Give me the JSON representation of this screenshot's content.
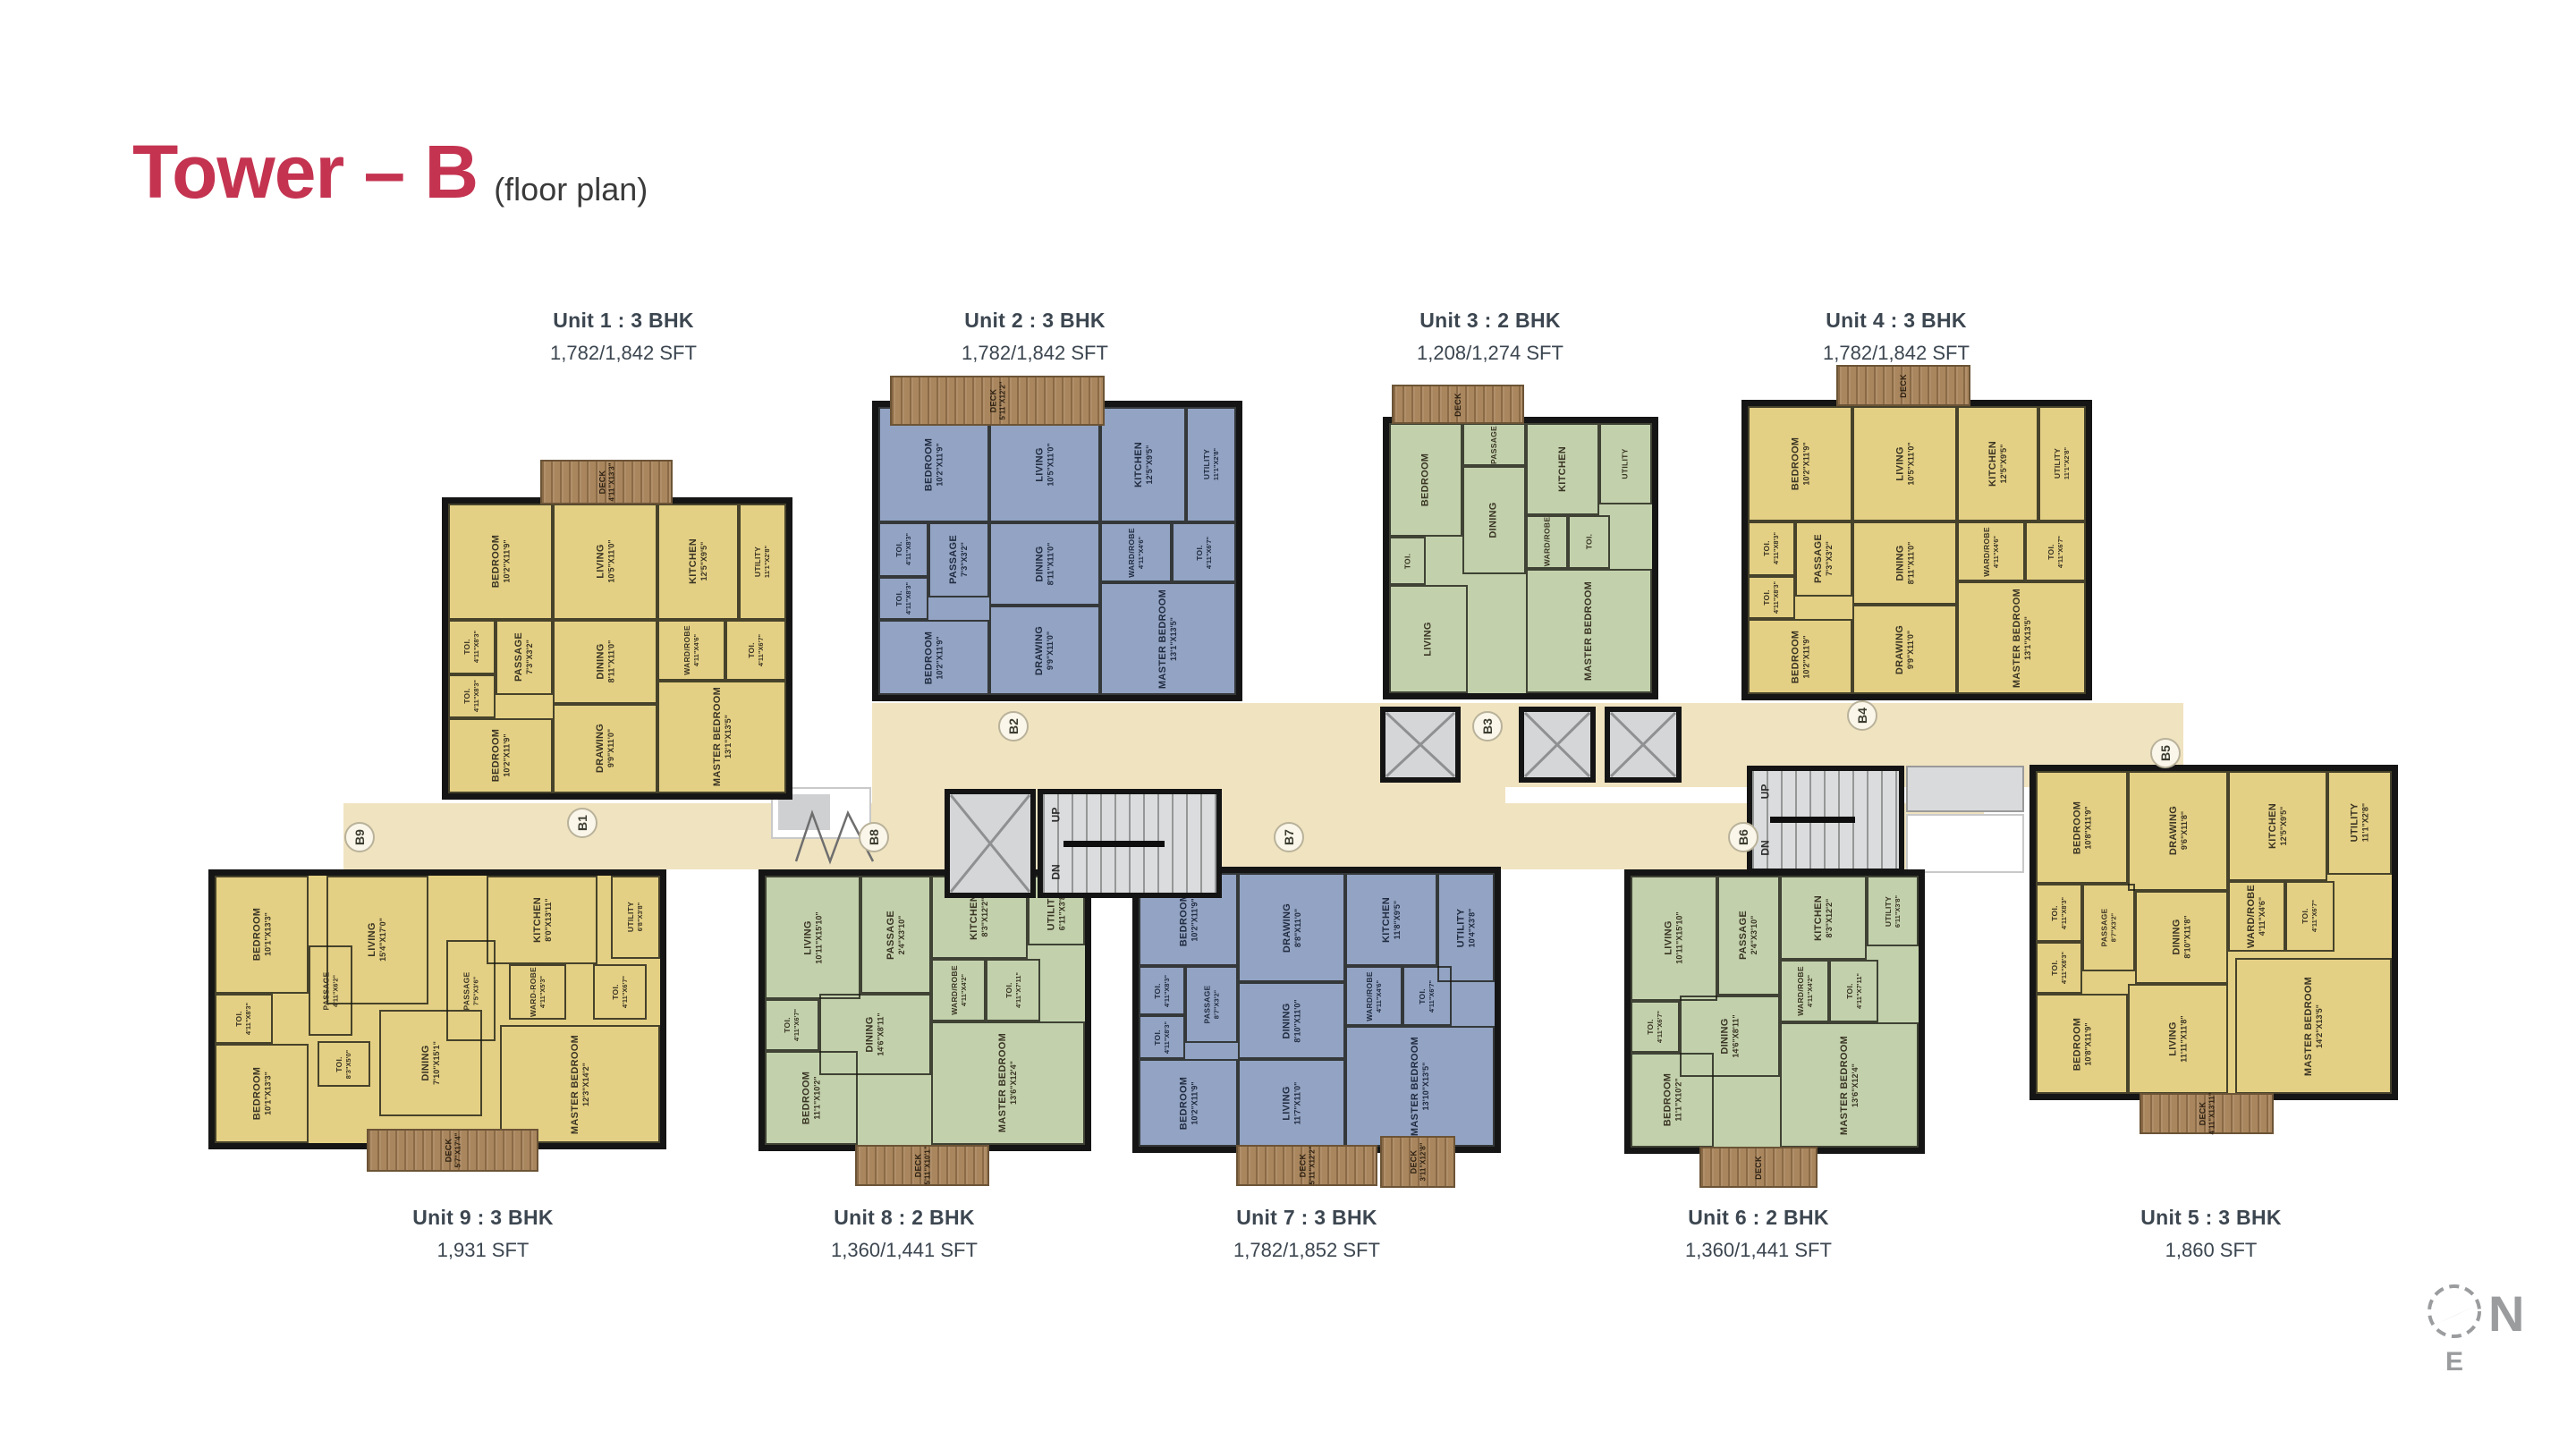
{
  "title": {
    "main": "Tower – B",
    "sub": "(floor plan)"
  },
  "colors": {
    "yellow": "#e4d084",
    "blue": "#92a3c3",
    "green": "#c2d1ac",
    "corridor": "#f0e3c0",
    "deck": "#a9865d",
    "wall": "#151515",
    "title_red": "#c43350",
    "label_text": "#3c4650"
  },
  "compass": {
    "n": "N",
    "e": "E"
  },
  "stairwell": {
    "up": "UP",
    "dn": "DN"
  },
  "typologies": {
    "t3": {
      "rooms": [
        {
          "n": "BEDROOM",
          "d": "10'2\"X11'9\"",
          "x": 0,
          "y": 0,
          "w": 31,
          "h": 40
        },
        {
          "n": "LIVING",
          "d": "10'5\"X11'0\"",
          "x": 31,
          "y": 0,
          "w": 31,
          "h": 40
        },
        {
          "n": "KITCHEN",
          "d": "12'5\"X9'5\"",
          "x": 62,
          "y": 0,
          "w": 24,
          "h": 40
        },
        {
          "n": "UTILITY",
          "d": "11'1\"X2'8\"",
          "x": 86,
          "y": 0,
          "w": 14,
          "h": 40
        },
        {
          "n": "TOI.",
          "d": "4'11\"X8'3\"",
          "x": 0,
          "y": 40,
          "w": 14,
          "h": 19
        },
        {
          "n": "PASSAGE",
          "d": "7'3\"X3'2\"",
          "x": 14,
          "y": 40,
          "w": 17,
          "h": 26
        },
        {
          "n": "DINING",
          "d": "8'11\"X11'0\"",
          "x": 31,
          "y": 40,
          "w": 31,
          "h": 29
        },
        {
          "n": "WARD/ROBE",
          "d": "4'11\"X4'6\"",
          "x": 62,
          "y": 40,
          "w": 20,
          "h": 21
        },
        {
          "n": "TOI.",
          "d": "4'11\"X6'7\"",
          "x": 82,
          "y": 40,
          "w": 18,
          "h": 21
        },
        {
          "n": "TOI.",
          "d": "4'11\"X8'3\"",
          "x": 0,
          "y": 59,
          "w": 14,
          "h": 15
        },
        {
          "n": "BEDROOM",
          "d": "10'2\"X11'9\"",
          "x": 0,
          "y": 74,
          "w": 31,
          "h": 26
        },
        {
          "n": "DRAWING",
          "d": "9'9\"X11'0\"",
          "x": 31,
          "y": 69,
          "w": 31,
          "h": 31
        },
        {
          "n": "MASTER BEDROOM",
          "d": "13'1\"X13'5\"",
          "x": 62,
          "y": 61,
          "w": 38,
          "h": 39
        }
      ]
    },
    "t2": {
      "rooms": [
        {
          "n": "LIVING",
          "d": "10'11\"X15'10\"",
          "x": 0,
          "y": 0,
          "w": 30,
          "h": 46
        },
        {
          "n": "PASSAGE",
          "d": "2'4\"X3'10\"",
          "x": 30,
          "y": 0,
          "w": 22,
          "h": 44
        },
        {
          "n": "KITCHEN",
          "d": "8'3\"X12'2\"",
          "x": 52,
          "y": 0,
          "w": 30,
          "h": 31
        },
        {
          "n": "UTILITY",
          "d": "6'11\"X3'8\"",
          "x": 82,
          "y": 0,
          "w": 18,
          "h": 26
        },
        {
          "n": "TOI.",
          "d": "4'11\"X6'7\"",
          "x": 0,
          "y": 46,
          "w": 17,
          "h": 19
        },
        {
          "n": "WARD/ROBE",
          "d": "4'11\"X4'2\"",
          "x": 52,
          "y": 31,
          "w": 17,
          "h": 23
        },
        {
          "n": "TOI.",
          "d": "4'11\"X7'11\"",
          "x": 69,
          "y": 31,
          "w": 17,
          "h": 23
        },
        {
          "n": "DINING",
          "d": "14'6\"X8'11\"",
          "x": 17,
          "y": 44,
          "w": 35,
          "h": 30
        },
        {
          "n": "BEDROOM",
          "d": "11'1\"X10'2\"",
          "x": 0,
          "y": 65,
          "w": 29,
          "h": 35
        },
        {
          "n": "MASTER BEDROOM",
          "d": "13'6\"X12'4\"",
          "x": 52,
          "y": 54,
          "w": 48,
          "h": 46
        }
      ]
    },
    "t3g": {
      "rooms": [
        {
          "n": "BEDROOM",
          "d": "",
          "x": 0,
          "y": 0,
          "w": 28,
          "h": 42
        },
        {
          "n": "DINING",
          "d": "",
          "x": 28,
          "y": 16,
          "w": 24,
          "h": 40
        },
        {
          "n": "KITCHEN",
          "d": "",
          "x": 52,
          "y": 0,
          "w": 28,
          "h": 34
        },
        {
          "n": "UTILITY",
          "d": "",
          "x": 80,
          "y": 0,
          "w": 20,
          "h": 30
        },
        {
          "n": "PASSAGE",
          "d": "",
          "x": 28,
          "y": 0,
          "w": 24,
          "h": 16
        },
        {
          "n": "TOI.",
          "d": "",
          "x": 0,
          "y": 42,
          "w": 14,
          "h": 18
        },
        {
          "n": "WARD/ROBE",
          "d": "",
          "x": 52,
          "y": 34,
          "w": 16,
          "h": 20
        },
        {
          "n": "TOI.",
          "d": "",
          "x": 68,
          "y": 34,
          "w": 16,
          "h": 20
        },
        {
          "n": "LIVING",
          "d": "",
          "x": 0,
          "y": 60,
          "w": 30,
          "h": 40
        },
        {
          "n": "MASTER BEDROOM",
          "d": "",
          "x": 52,
          "y": 54,
          "w": 48,
          "h": 46
        }
      ]
    },
    "t7": {
      "rooms": [
        {
          "n": "BEDROOM",
          "d": "10'2\"X11'9\"",
          "x": 0,
          "y": 0,
          "w": 28,
          "h": 34
        },
        {
          "n": "DRAWING",
          "d": "8'8\"X11'0\"",
          "x": 28,
          "y": 0,
          "w": 30,
          "h": 40
        },
        {
          "n": "KITCHEN",
          "d": "11'8\"X9'5\"",
          "x": 58,
          "y": 0,
          "w": 26,
          "h": 34
        },
        {
          "n": "UTILITY",
          "d": "10'4\"X3'8\"",
          "x": 84,
          "y": 0,
          "w": 16,
          "h": 40
        },
        {
          "n": "TOI.",
          "d": "4'11\"X8'3\"",
          "x": 0,
          "y": 34,
          "w": 13,
          "h": 18
        },
        {
          "n": "PASSAGE",
          "d": "8'7\"X3'2\"",
          "x": 13,
          "y": 34,
          "w": 15,
          "h": 28
        },
        {
          "n": "DINING",
          "d": "8'10\"X11'0\"",
          "x": 28,
          "y": 40,
          "w": 30,
          "h": 28
        },
        {
          "n": "WARD/ROBE",
          "d": "4'11\"X4'6\"",
          "x": 58,
          "y": 34,
          "w": 16,
          "h": 22
        },
        {
          "n": "TOI.",
          "d": "4'11\"X6'7\"",
          "x": 74,
          "y": 34,
          "w": 14,
          "h": 22
        },
        {
          "n": "TOI.",
          "d": "4'11\"X8'3\"",
          "x": 0,
          "y": 52,
          "w": 13,
          "h": 16
        },
        {
          "n": "BEDROOM",
          "d": "10'2\"X11'9\"",
          "x": 0,
          "y": 68,
          "w": 28,
          "h": 32
        },
        {
          "n": "LIVING",
          "d": "11'7\"X11'0\"",
          "x": 28,
          "y": 68,
          "w": 30,
          "h": 32
        },
        {
          "n": "MASTER BEDROOM",
          "d": "13'10\"X13'5\"",
          "x": 58,
          "y": 56,
          "w": 42,
          "h": 44
        }
      ]
    },
    "t9": {
      "rooms": [
        {
          "n": "BEDROOM",
          "d": "10'1\"X13'3\"",
          "x": 0,
          "y": 0,
          "w": 21,
          "h": 44
        },
        {
          "n": "LIVING",
          "d": "15'4\"X17'0\"",
          "x": 25,
          "y": 0,
          "w": 23,
          "h": 48
        },
        {
          "n": "KITCHEN",
          "d": "8'0\"X13'11\"",
          "x": 61,
          "y": 0,
          "w": 25,
          "h": 33
        },
        {
          "n": "UTILITY",
          "d": "6'8\"X3'8\"",
          "x": 89,
          "y": 0,
          "w": 11,
          "h": 31
        },
        {
          "n": "PASSAGE",
          "d": "4'11\"X6'2\"",
          "x": 21,
          "y": 26,
          "w": 10,
          "h": 34
        },
        {
          "n": "TOI.",
          "d": "4'11\"X8'3\"",
          "x": 0,
          "y": 44,
          "w": 13,
          "h": 19
        },
        {
          "n": "PASSAGE",
          "d": "7'5\"X3'6\"",
          "x": 52,
          "y": 24,
          "w": 11,
          "h": 38
        },
        {
          "n": "WARD-ROBE",
          "d": "4'11\"X5'3\"",
          "x": 66,
          "y": 33,
          "w": 13,
          "h": 21
        },
        {
          "n": "TOI.",
          "d": "4'11\"X6'7\"",
          "x": 85,
          "y": 33,
          "w": 12,
          "h": 21
        },
        {
          "n": "BEDROOM",
          "d": "10'1\"X13'3\"",
          "x": 0,
          "y": 63,
          "w": 21,
          "h": 37
        },
        {
          "n": "TOI.",
          "d": "8'3\"X5'0\"",
          "x": 23,
          "y": 62,
          "w": 12,
          "h": 17
        },
        {
          "n": "DINING",
          "d": "7'10\"X15'1\"",
          "x": 37,
          "y": 50,
          "w": 23,
          "h": 40
        },
        {
          "n": "MASTER BEDROOM",
          "d": "12'3\"X14'2\"",
          "x": 64,
          "y": 56,
          "w": 36,
          "h": 44
        }
      ]
    },
    "t5": {
      "rooms": [
        {
          "n": "BEDROOM",
          "d": "10'8\"X11'9\"",
          "x": 0,
          "y": 0,
          "w": 26,
          "h": 35
        },
        {
          "n": "DRAWING",
          "d": "9'6\"X11'8\"",
          "x": 26,
          "y": 0,
          "w": 28,
          "h": 37
        },
        {
          "n": "KITCHEN",
          "d": "12'5\"X9'5\"",
          "x": 54,
          "y": 0,
          "w": 28,
          "h": 34
        },
        {
          "n": "UTILITY",
          "d": "11'1\"X2'8\"",
          "x": 82,
          "y": 0,
          "w": 18,
          "h": 32
        },
        {
          "n": "TOI.",
          "d": "4'11\"X8'3\"",
          "x": 0,
          "y": 35,
          "w": 13,
          "h": 18
        },
        {
          "n": "PASSAGE",
          "d": "8'7\"X3'2\"",
          "x": 13,
          "y": 35,
          "w": 15,
          "h": 27
        },
        {
          "n": "DINING",
          "d": "8'10\"X11'8\"",
          "x": 28,
          "y": 37,
          "w": 26,
          "h": 29
        },
        {
          "n": "WARD/ROBE",
          "d": "4'11\"X4'6\"",
          "x": 54,
          "y": 34,
          "w": 16,
          "h": 22
        },
        {
          "n": "TOI.",
          "d": "4'11\"X6'7\"",
          "x": 70,
          "y": 34,
          "w": 14,
          "h": 22
        },
        {
          "n": "TOI.",
          "d": "4'11\"X8'3\"",
          "x": 0,
          "y": 53,
          "w": 13,
          "h": 16
        },
        {
          "n": "BEDROOM",
          "d": "10'8\"X11'9\"",
          "x": 0,
          "y": 69,
          "w": 26,
          "h": 31
        },
        {
          "n": "LIVING",
          "d": "11'11\"X11'8\"",
          "x": 26,
          "y": 66,
          "w": 28,
          "h": 34
        },
        {
          "n": "MASTER BEDROOM",
          "d": "14'2\"X13'5\"",
          "x": 56,
          "y": 58,
          "w": 44,
          "h": 42
        }
      ]
    }
  },
  "units": [
    {
      "id": "unit-1",
      "label": "Unit 1 : 3 BHK",
      "area": "1,782/1,842 SFT",
      "color": "yellow",
      "typ": "t3",
      "badge": "B1",
      "box": [
        494,
        556,
        392,
        338
      ],
      "label_cx": 697,
      "label_top": 345,
      "badge_c": [
        651,
        920
      ],
      "decks": [
        {
          "r": [
            604,
            514,
            148,
            50
          ],
          "name": "DECK",
          "dim": "4'11\"X13'3\""
        }
      ]
    },
    {
      "id": "unit-2",
      "label": "Unit 2 : 3 BHK",
      "area": "1,782/1,842 SFT",
      "color": "blue",
      "typ": "t3",
      "badge": "B2",
      "box": [
        975,
        448,
        414,
        336
      ],
      "label_cx": 1157,
      "label_top": 345,
      "badge_c": [
        1133,
        812
      ],
      "decks": [
        {
          "r": [
            995,
            420,
            240,
            56
          ],
          "name": "DECK",
          "dim": "5'11\"X12'2\""
        }
      ]
    },
    {
      "id": "unit-3",
      "label": "Unit 3 : 2 BHK",
      "area": "1,208/1,274 SFT",
      "color": "green",
      "typ": "t3g",
      "badge": "B3",
      "box": [
        1546,
        466,
        308,
        316
      ],
      "label_cx": 1666,
      "label_top": 345,
      "badge_c": [
        1663,
        812
      ],
      "decks": [
        {
          "r": [
            1556,
            430,
            148,
            44
          ],
          "name": "DECK",
          "dim": ""
        }
      ]
    },
    {
      "id": "unit-4",
      "label": "Unit 4 : 3 BHK",
      "area": "1,782/1,842 SFT",
      "color": "yellow",
      "typ": "t3",
      "badge": "B4",
      "box": [
        1947,
        447,
        392,
        336
      ],
      "label_cx": 2120,
      "label_top": 345,
      "badge_c": [
        2082,
        800
      ],
      "decks": [
        {
          "r": [
            2053,
            408,
            150,
            46
          ],
          "name": "DECK",
          "dim": ""
        }
      ]
    },
    {
      "id": "unit-5",
      "label": "Unit 5 : 3 BHK",
      "area": "1,860 SFT",
      "color": "yellow",
      "typ": "t5",
      "badge": "B5",
      "box": [
        2269,
        855,
        412,
        375
      ],
      "label_cx": 2472,
      "label_top": 1348,
      "badge_c": [
        2421,
        842
      ],
      "decks": [
        {
          "r": [
            2392,
            1222,
            150,
            46
          ],
          "name": "DECK",
          "dim": "4'11\"X13'11\""
        }
      ]
    },
    {
      "id": "unit-6",
      "label": "Unit 6 : 2 BHK",
      "area": "1,360/1,441 SFT",
      "color": "green",
      "typ": "t2",
      "badge": "B6",
      "box": [
        1816,
        972,
        336,
        318
      ],
      "label_cx": 1966,
      "label_top": 1348,
      "badge_c": [
        1949,
        936
      ],
      "decks": [
        {
          "r": [
            1900,
            1282,
            132,
            46
          ],
          "name": "DECK",
          "dim": ""
        }
      ]
    },
    {
      "id": "unit-7",
      "label": "Unit 7 : 3 BHK",
      "area": "1,782/1,852 SFT",
      "color": "blue",
      "typ": "t7",
      "badge": "B7",
      "box": [
        1266,
        969,
        412,
        320
      ],
      "label_cx": 1461,
      "label_top": 1348,
      "badge_c": [
        1441,
        936
      ],
      "decks": [
        {
          "r": [
            1382,
            1280,
            158,
            46
          ],
          "name": "DECK",
          "dim": "5'11\"X12'2\""
        },
        {
          "r": [
            1543,
            1270,
            84,
            58
          ],
          "name": "DECK",
          "dim": "3'11\"X12'8\""
        }
      ]
    },
    {
      "id": "unit-8",
      "label": "Unit 8 : 2 BHK",
      "area": "1,360/1,441 SFT",
      "color": "green",
      "typ": "t2",
      "badge": "B8",
      "box": [
        848,
        972,
        372,
        315
      ],
      "label_cx": 1011,
      "label_top": 1348,
      "badge_c": [
        977,
        936
      ],
      "decks": [
        {
          "r": [
            956,
            1280,
            150,
            46
          ],
          "name": "DECK",
          "dim": "5'11\"X10'1\""
        }
      ]
    },
    {
      "id": "unit-9",
      "label": "Unit 9 : 3 BHK",
      "area": "1,931 SFT",
      "color": "yellow",
      "typ": "t9",
      "badge": "B9",
      "box": [
        233,
        972,
        512,
        313
      ],
      "label_cx": 540,
      "label_top": 1348,
      "badge_c": [
        402,
        936
      ],
      "decks": [
        {
          "r": [
            410,
            1262,
            192,
            48
          ],
          "name": "DECK",
          "dim": "5'7\"X17'4\""
        }
      ]
    }
  ],
  "corridor": {
    "segments": [
      [
        975,
        786,
        1466,
        94
      ],
      [
        384,
        898,
        1834,
        74
      ],
      [
        975,
        860,
        708,
        60
      ]
    ],
    "elevators": [
      [
        1056,
        882,
        102,
        122
      ],
      [
        1543,
        790,
        90,
        85
      ],
      [
        1698,
        790,
        86,
        85
      ],
      [
        1794,
        790,
        86,
        85
      ]
    ],
    "stairs": [
      [
        1160,
        882,
        206,
        122
      ],
      [
        1953,
        856,
        176,
        121
      ]
    ],
    "lobbies": [
      [
        862,
        880,
        112,
        58
      ],
      [
        2131,
        910,
        132,
        66
      ]
    ],
    "vestibules": [
      [
        2131,
        856,
        132,
        52
      ]
    ],
    "joints": [
      [
        888,
        905,
        90,
        62
      ]
    ]
  }
}
